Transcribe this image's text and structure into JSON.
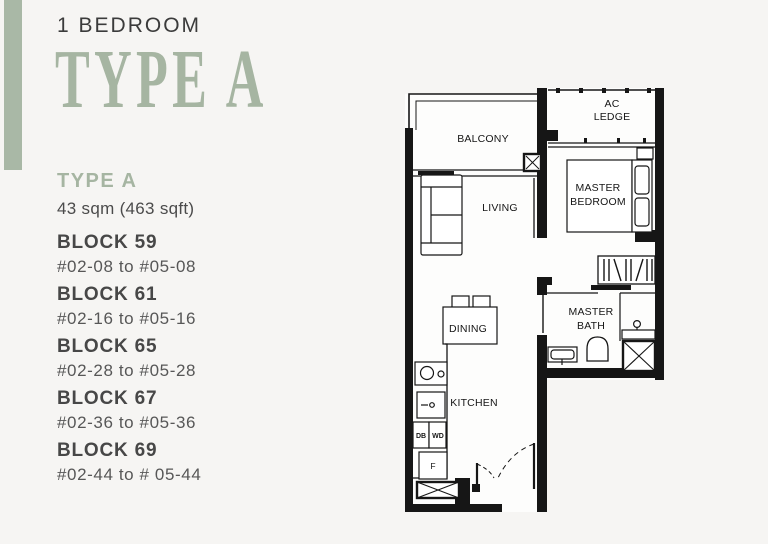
{
  "header": {
    "category": "1 BEDROOM",
    "type_title": "TYPE A"
  },
  "unit_info": {
    "type_label": "TYPE A",
    "area": "43 sqm (463 sqft)"
  },
  "blocks": [
    {
      "name": "BLOCK 59",
      "range": "#02-08 to #05-08"
    },
    {
      "name": "BLOCK 61",
      "range": "#02-16 to #05-16"
    },
    {
      "name": "BLOCK 65",
      "range": "#02-28 to #05-28"
    },
    {
      "name": "BLOCK 67",
      "range": "#02-36 to #05-36"
    },
    {
      "name": "BLOCK 69",
      "range": "#02-44 to # 05-44"
    }
  ],
  "floorplan": {
    "rooms": {
      "balcony": "BALCONY",
      "ac_ledge_line1": "AC",
      "ac_ledge_line2": "LEDGE",
      "master_bedroom_line1": "MASTER",
      "master_bedroom_line2": "BEDROOM",
      "living": "LIVING",
      "dining": "DINING",
      "kitchen": "KITCHEN",
      "master_bath_line1": "MASTER",
      "master_bath_line2": "BATH"
    },
    "appliances": {
      "db": "DB",
      "wd": "WD",
      "fridge": "F"
    }
  },
  "colors": {
    "accent_green": "#a6b5a2",
    "accent_bar_green": "#a9b8a6",
    "heading_dark": "#3b3b3b",
    "body_gray": "#575757",
    "plan_line": "#161616",
    "background": "#f6f5f3"
  }
}
